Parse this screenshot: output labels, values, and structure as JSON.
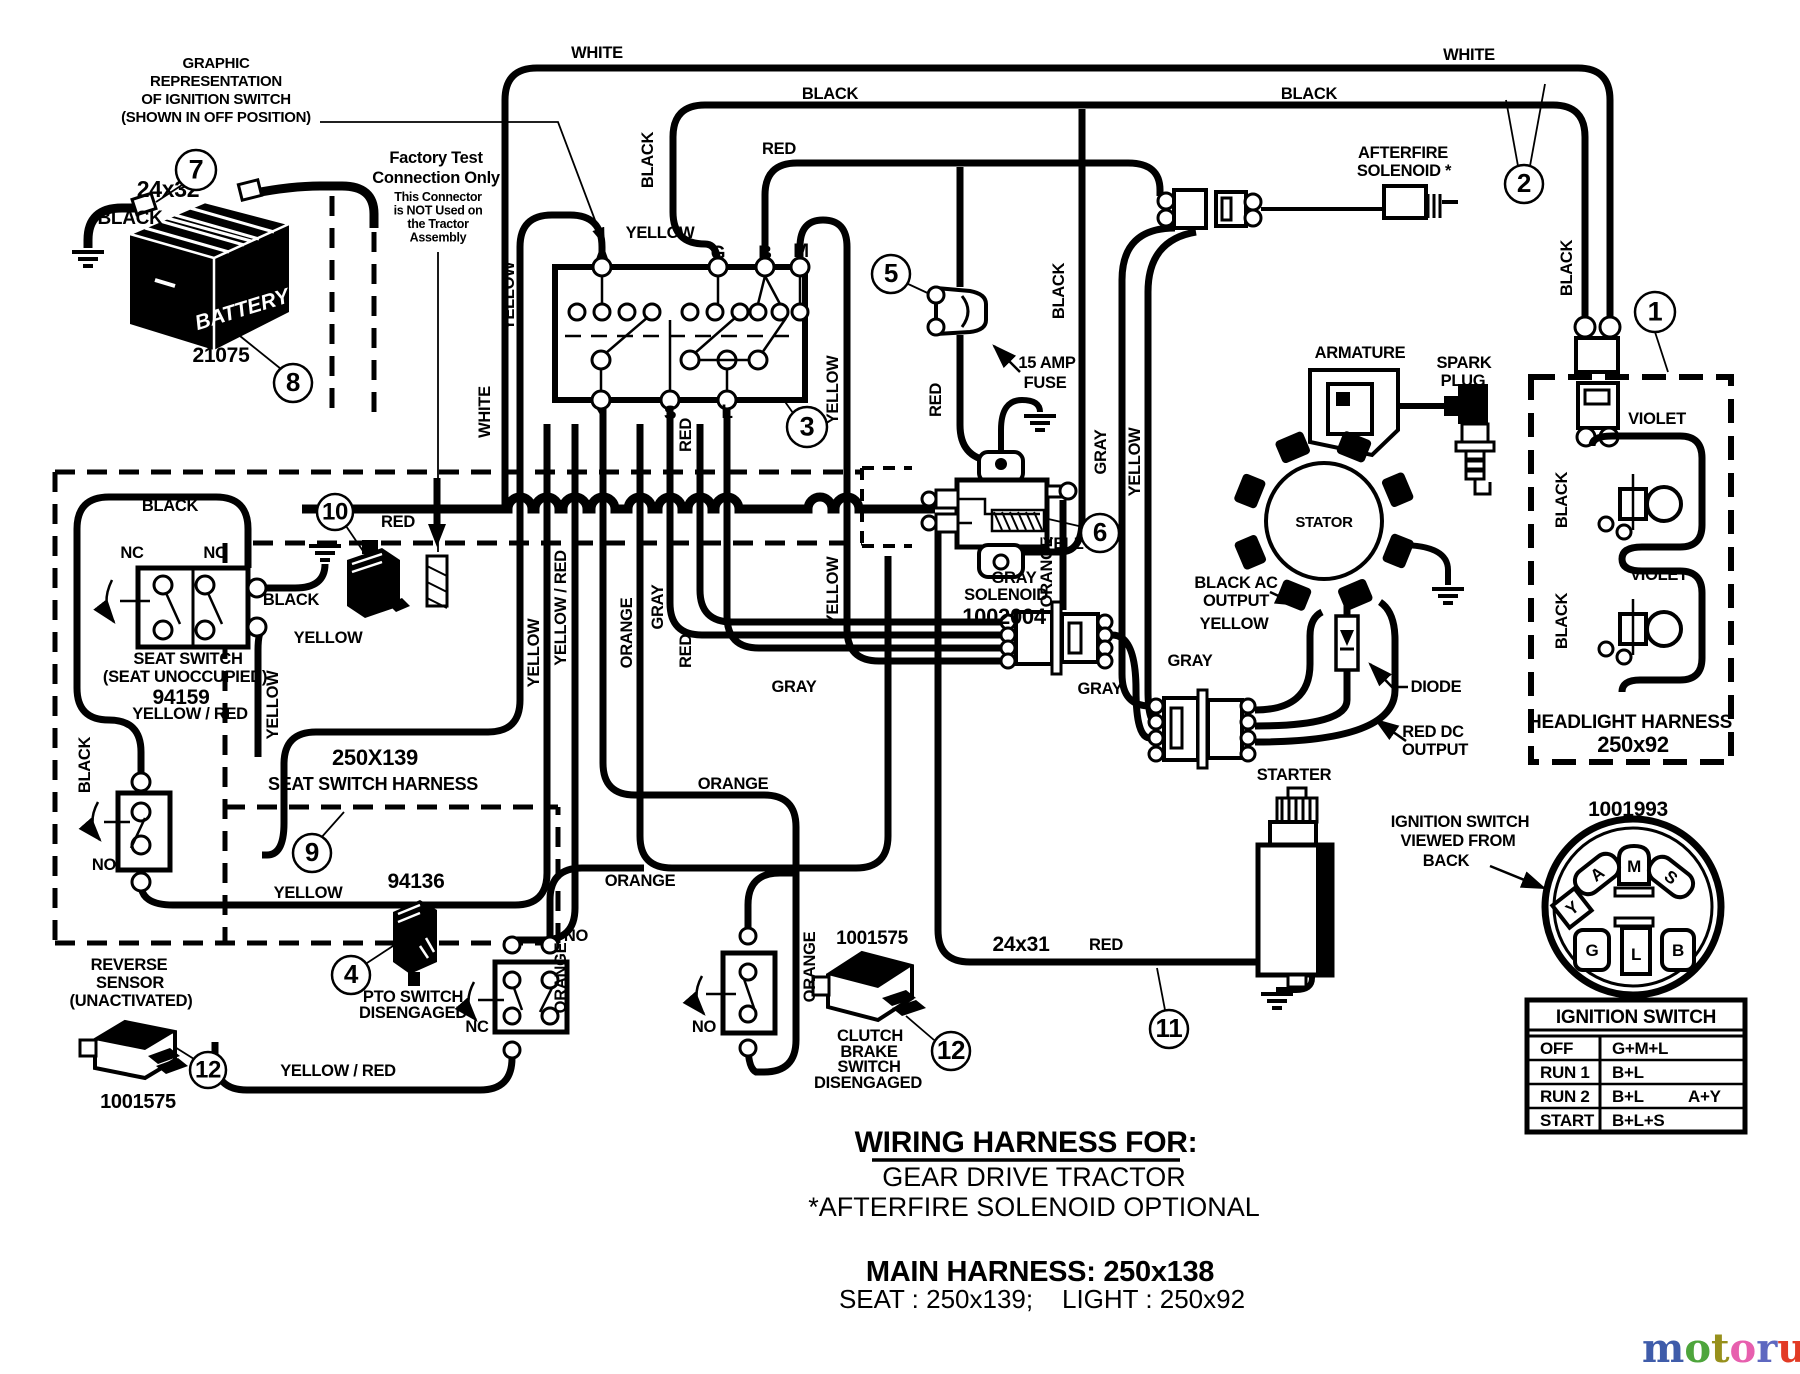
{
  "doc_type": "wiring-diagram",
  "notes": {
    "graphic_rep": [
      "GRAPHIC",
      "REPRESENTATION",
      "OF  IGNITION  SWITCH",
      "(SHOWN  IN  OFF  POSITION)"
    ],
    "factory_bold": [
      "Factory Test",
      "Connection Only"
    ],
    "factory_small": [
      "This Connector",
      "is NOT Used on",
      "the Tractor",
      "Assembly"
    ]
  },
  "battery": {
    "label": "BATTERY",
    "part": "21075",
    "cable": "24x32"
  },
  "labels": [
    {
      "t": "WHITE",
      "x": 597,
      "y": 58
    },
    {
      "t": "BLACK",
      "x": 830,
      "y": 99
    },
    {
      "t": "RED",
      "x": 779,
      "y": 154
    },
    {
      "t": "BLACK",
      "x": 653,
      "y": 160,
      "v": true
    },
    {
      "t": "YELLOW",
      "x": 660,
      "y": 238
    },
    {
      "t": "WHITE",
      "x": 1469,
      "y": 60
    },
    {
      "t": "BLACK",
      "x": 1309,
      "y": 99
    },
    {
      "t": "BLACK",
      "x": 1572,
      "y": 268,
      "v": true
    },
    {
      "t": "YELLOW",
      "x": 514,
      "y": 296,
      "v": true
    },
    {
      "t": "WHITE",
      "x": 490,
      "y": 412,
      "v": true
    },
    {
      "t": "RED",
      "x": 941,
      "y": 400,
      "v": true
    },
    {
      "t": "BLACK",
      "x": 1064,
      "y": 291,
      "v": true
    },
    {
      "t": "GRAY",
      "x": 1106,
      "y": 452,
      "v": true
    },
    {
      "t": "YELLOW",
      "x": 1140,
      "y": 462,
      "v": true
    },
    {
      "t": "RED",
      "x": 691,
      "y": 435,
      "v": true
    },
    {
      "t": "YELLOW",
      "x": 838,
      "y": 390,
      "v": true
    },
    {
      "t": "RED",
      "x": 691,
      "y": 651,
      "v": true
    },
    {
      "t": "YELLOW",
      "x": 838,
      "y": 591,
      "v": true
    },
    {
      "t": "YELLOW / RED",
      "x": 566,
      "y": 608,
      "v": true
    },
    {
      "t": "YELLOW",
      "x": 539,
      "y": 653,
      "v": true
    },
    {
      "t": "ORANGE",
      "x": 632,
      "y": 633,
      "v": true
    },
    {
      "t": "GRAY",
      "x": 663,
      "y": 607,
      "v": true
    },
    {
      "t": "GRAY",
      "x": 794,
      "y": 692
    },
    {
      "t": "GRAY",
      "x": 1100,
      "y": 694
    },
    {
      "t": "GRAY",
      "x": 1190,
      "y": 666
    },
    {
      "t": "BLACK",
      "x": 170,
      "y": 511
    },
    {
      "t": "BLACK",
      "x": 291,
      "y": 605
    },
    {
      "t": "YELLOW",
      "x": 328,
      "y": 643
    },
    {
      "t": "YELLOW",
      "x": 278,
      "y": 705,
      "v": true
    },
    {
      "t": "BLACK",
      "x": 90,
      "y": 765,
      "v": true
    },
    {
      "t": "YELLOW",
      "x": 308,
      "y": 898
    },
    {
      "t": "RED",
      "x": 398,
      "y": 527
    },
    {
      "t": "ORANGE",
      "x": 733,
      "y": 789
    },
    {
      "t": "ORANGE",
      "x": 640,
      "y": 886
    },
    {
      "t": "ORANGE",
      "x": 566,
      "y": 978,
      "v": true
    },
    {
      "t": "ORANGE",
      "x": 815,
      "y": 967,
      "v": true
    },
    {
      "t": "ORANGE",
      "x": 1052,
      "y": 572,
      "v": true
    },
    {
      "t": "YELLOW",
      "x": 1234,
      "y": 629
    },
    {
      "t": "YELLOW",
      "x": 1077,
      "y": 549
    },
    {
      "t": "GRAY",
      "x": 1014,
      "y": 583
    },
    {
      "t": "24x32",
      "x": 168,
      "y": 197,
      "s": 23
    },
    {
      "t": "BLACK",
      "x": 130,
      "y": 224,
      "s": 19
    },
    {
      "t": "24x31",
      "x": 1021,
      "y": 951,
      "s": 21
    },
    {
      "t": "RED",
      "x": 1106,
      "y": 950
    },
    {
      "t": "YELLOW / RED",
      "x": 338,
      "y": 1076
    },
    {
      "t": "VIOLET",
      "x": 1657,
      "y": 424
    },
    {
      "t": "VIOLET",
      "x": 1659,
      "y": 580
    },
    {
      "t": "BLACK",
      "x": 1567,
      "y": 500,
      "v": true
    },
    {
      "t": "BLACK",
      "x": 1567,
      "y": 621,
      "v": true
    },
    {
      "t": "AFTERFIRE",
      "x": 1403,
      "y": 158
    },
    {
      "t": "SOLENOID *",
      "x": 1404,
      "y": 176
    },
    {
      "t": "ARMATURE",
      "x": 1360,
      "y": 358
    },
    {
      "t": "SPARK",
      "x": 1464,
      "y": 368
    },
    {
      "t": "PLUG",
      "x": 1463,
      "y": 386
    },
    {
      "t": "STATOR",
      "x": 1324,
      "y": 527,
      "s": 15
    },
    {
      "t": "SOLENOID",
      "x": 1006,
      "y": 600
    },
    {
      "t": "1002004",
      "x": 1004,
      "y": 624,
      "s": 22
    },
    {
      "t": "BLACK AC",
      "x": 1236,
      "y": 588
    },
    {
      "t": "OUTPUT",
      "x": 1236,
      "y": 606
    },
    {
      "t": "DIODE",
      "x": 1436,
      "y": 692
    },
    {
      "t": "RED DC",
      "x": 1433,
      "y": 737
    },
    {
      "t": "OUTPUT",
      "x": 1435,
      "y": 755
    },
    {
      "t": "STARTER",
      "x": 1294,
      "y": 780
    },
    {
      "t": "1001993",
      "x": 1628,
      "y": 816,
      "s": 21
    },
    {
      "t": "HEADLIGHT HARNESS",
      "x": 1630,
      "y": 728,
      "s": 19
    },
    {
      "t": "250x92",
      "x": 1633,
      "y": 752,
      "s": 22
    },
    {
      "t": "15 AMP",
      "x": 1047,
      "y": 368
    },
    {
      "t": "FUSE",
      "x": 1045,
      "y": 388
    },
    {
      "t": "NC",
      "x": 132,
      "y": 558
    },
    {
      "t": "NC",
      "x": 215,
      "y": 558
    },
    {
      "t": "SEAT SWITCH",
      "x": 188,
      "y": 664
    },
    {
      "t": "(SEAT UNOCCUPIED)",
      "x": 185,
      "y": 682
    },
    {
      "t": "94159",
      "x": 181,
      "y": 704,
      "s": 21
    },
    {
      "t": "YELLOW / RED",
      "x": 190,
      "y": 719
    },
    {
      "t": "250X139",
      "x": 375,
      "y": 765,
      "s": 22
    },
    {
      "t": "SEAT SWITCH HARNESS",
      "x": 373,
      "y": 790,
      "s": 18
    },
    {
      "t": "REVERSE",
      "x": 129,
      "y": 970
    },
    {
      "t": "SENSOR",
      "x": 130,
      "y": 988
    },
    {
      "t": "(UNACTIVATED)",
      "x": 131,
      "y": 1006
    },
    {
      "t": "1001575",
      "x": 138,
      "y": 1108,
      "s": 20
    },
    {
      "t": "94136",
      "x": 416,
      "y": 888,
      "s": 21
    },
    {
      "t": "PTO SWITCH",
      "x": 413,
      "y": 1002
    },
    {
      "t": "DISENGAGED",
      "x": 413,
      "y": 1018
    },
    {
      "t": "NO",
      "x": 576,
      "y": 941
    },
    {
      "t": "NC",
      "x": 477,
      "y": 1032
    },
    {
      "t": "NO",
      "x": 104,
      "y": 870
    },
    {
      "t": "NO",
      "x": 704,
      "y": 1032
    },
    {
      "t": "1001575",
      "x": 872,
      "y": 944,
      "s": 19
    },
    {
      "t": "CLUTCH",
      "x": 870,
      "y": 1041
    },
    {
      "t": "BRAKE",
      "x": 869,
      "y": 1057
    },
    {
      "t": "SWITCH",
      "x": 869,
      "y": 1072
    },
    {
      "t": "DISENGAGED",
      "x": 868,
      "y": 1088
    },
    {
      "t": "21075",
      "x": 221,
      "y": 362,
      "s": 21
    },
    {
      "t": "IGNITION SWITCH",
      "x": 1460,
      "y": 827
    },
    {
      "t": "VIEWED  FROM",
      "x": 1458,
      "y": 846
    },
    {
      "t": "BACK",
      "x": 1446,
      "y": 866
    },
    {
      "t": "A",
      "x": 602,
      "y": 260,
      "s": 19
    },
    {
      "t": "G",
      "x": 718,
      "y": 259,
      "s": 19
    },
    {
      "t": "B",
      "x": 765,
      "y": 259,
      "s": 19
    },
    {
      "t": "M",
      "x": 801,
      "y": 257,
      "s": 19
    },
    {
      "t": "Y",
      "x": 601,
      "y": 420,
      "s": 19
    },
    {
      "t": "S",
      "x": 670,
      "y": 419,
      "s": 19
    },
    {
      "t": "L",
      "x": 727,
      "y": 418,
      "s": 19
    }
  ],
  "callouts": [
    {
      "n": "1",
      "x": 1655,
      "y": 312,
      "r": 20
    },
    {
      "n": "2",
      "x": 1524,
      "y": 184,
      "r": 19
    },
    {
      "n": "3",
      "x": 807,
      "y": 427,
      "r": 20
    },
    {
      "n": "4",
      "x": 351,
      "y": 975,
      "r": 19
    },
    {
      "n": "5",
      "x": 891,
      "y": 274,
      "r": 19
    },
    {
      "n": "6",
      "x": 1100,
      "y": 533,
      "r": 19
    },
    {
      "n": "7",
      "x": 196,
      "y": 170,
      "r": 20
    },
    {
      "n": "8",
      "x": 293,
      "y": 383,
      "r": 19
    },
    {
      "n": "9",
      "x": 312,
      "y": 853,
      "r": 19
    },
    {
      "n": "10",
      "x": 335,
      "y": 512,
      "r": 18
    },
    {
      "n": "11",
      "x": 1169,
      "y": 1029,
      "r": 19
    },
    {
      "n": "12",
      "x": 208,
      "y": 1070,
      "r": 18
    },
    {
      "n": "12",
      "x": 951,
      "y": 1051,
      "r": 19
    }
  ],
  "ignition_back": {
    "part": "1001993",
    "terminals": {
      "m": "M",
      "a": "A",
      "s": "S",
      "y": "Y",
      "g": "G",
      "l": "L",
      "b": "B"
    }
  },
  "table": {
    "title": "IGNITION SWITCH",
    "rows": [
      [
        "OFF",
        "G+M+L",
        ""
      ],
      [
        "RUN 1",
        "B+L",
        ""
      ],
      [
        "RUN 2",
        "B+L",
        "A+Y"
      ],
      [
        "START",
        "B+L+S",
        ""
      ]
    ]
  },
  "title_block": {
    "l1": "WIRING HARNESS FOR:",
    "l2": "GEAR DRIVE TRACTOR",
    "l3": "*AFTERFIRE SOLENOID OPTIONAL",
    "l4": "MAIN HARNESS: 250x138",
    "l5": "SEAT : 250x139;    LIGHT : 250x92"
  },
  "logo": {
    "letters": [
      {
        "ch": "m",
        "c": "#3f5caa"
      },
      {
        "ch": "o",
        "c": "#4ea53c"
      },
      {
        "ch": "t",
        "c": "#97901c"
      },
      {
        "ch": "o",
        "c": "#e75fae"
      },
      {
        "ch": "r",
        "c": "#5e68c0"
      },
      {
        "ch": "u",
        "c": "#e23b25"
      },
      {
        "ch": "f",
        "c": "#f0a12b"
      }
    ],
    "suffix": ".de",
    "suffix_color": "#9a9a9a"
  }
}
